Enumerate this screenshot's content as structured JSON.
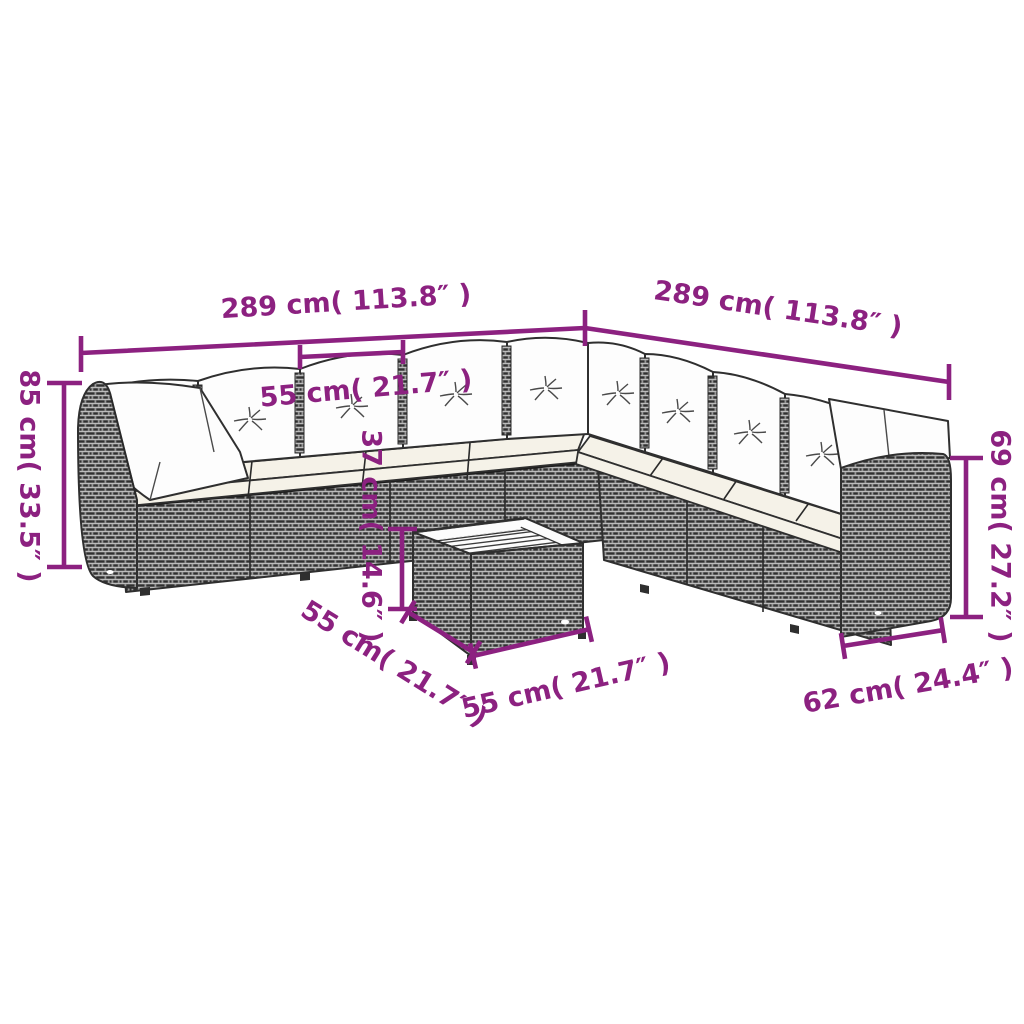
{
  "canvas": {
    "width": 1024,
    "height": 1024,
    "background": "#ffffff"
  },
  "colors": {
    "accent": "#8c2180",
    "line_art": "#2f2f2f",
    "rattan_gray": "#989898",
    "cushion_white": "#fdfdfd",
    "seat_cream": "#f5f2e8"
  },
  "figure": {
    "subject": "corner-sofa-set-with-coffee-table-dimension-diagram"
  },
  "dimensions": {
    "left_back_width": "289 cm( 113.8″ )",
    "right_back_width": "289 cm( 113.8″ )",
    "back_cushion_width": "55 cm( 21.7″ )",
    "total_height": "85 cm( 33.5″ )",
    "backrest_height": "69 cm( 27.2″ )",
    "table_height": "37 cm( 14.6″ )",
    "table_depth": "55 cm( 21.7″ )",
    "table_width": "55 cm( 21.7″ )",
    "module_depth": "62 cm( 24.4″ )"
  }
}
